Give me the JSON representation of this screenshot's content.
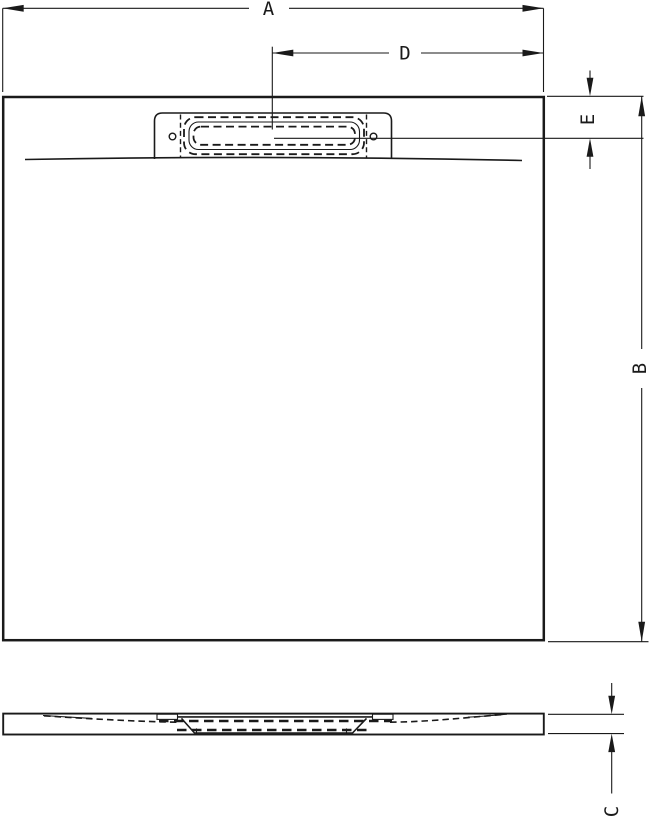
{
  "drawing": {
    "background_color": "#ffffff",
    "line_color": "#1a1a1a"
  },
  "dimensions": {
    "overall_width": {
      "label": "A"
    },
    "overall_depth": {
      "label": "B"
    },
    "tray_height": {
      "label": "C"
    },
    "drain_center_to_right_edge": {
      "label": "D"
    },
    "top_edge_to_drain_center": {
      "label": "E"
    }
  }
}
